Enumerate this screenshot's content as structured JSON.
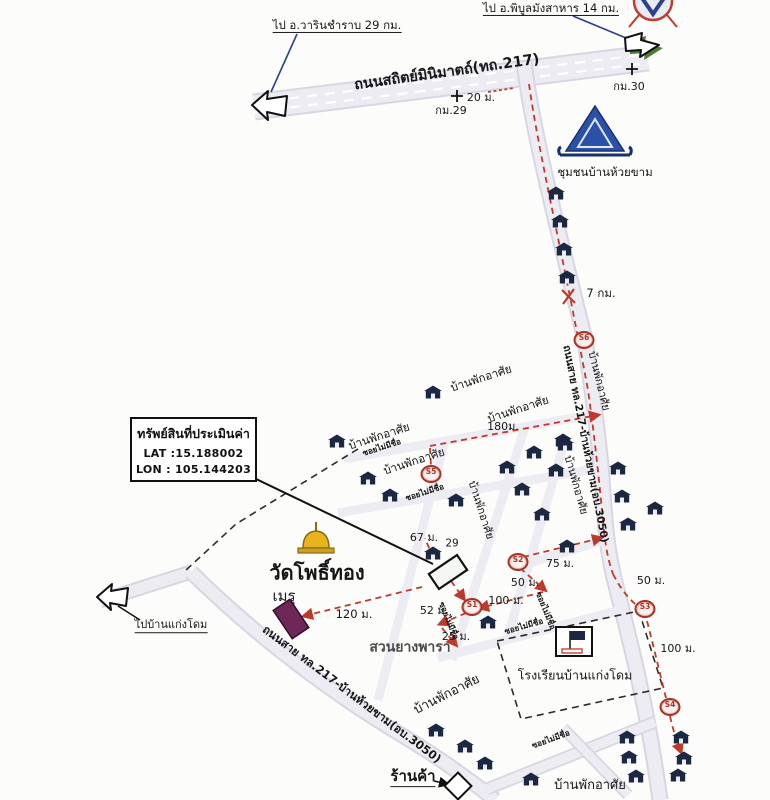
{
  "colors": {
    "road_fill": "#ececf2",
    "road_edge": "#d7d7e2",
    "route_red": "#bf3a2c",
    "house_navy": "#1c2742",
    "temple_blue": "#2b51a7",
    "pagoda_gold": "#e7b31f",
    "meru_purple": "#6f2757",
    "leader_blue": "#2c3f8f",
    "arrow_shadow_green": "#4d7c33"
  },
  "property_box": {
    "title": "ทรัพย์สินที่ประเมินค่า",
    "lat": "LAT :15.188002",
    "lon": "LON : 105.144203"
  },
  "stations": [
    {
      "label": "S1",
      "x": 472,
      "y": 607
    },
    {
      "label": "S2",
      "x": 518,
      "y": 562
    },
    {
      "label": "S3",
      "x": 645,
      "y": 609
    },
    {
      "label": "S4",
      "x": 670,
      "y": 707
    },
    {
      "label": "S5",
      "x": 431,
      "y": 474
    },
    {
      "label": "S6",
      "x": 584,
      "y": 340
    }
  ],
  "houses": [
    [
      556,
      193
    ],
    [
      560,
      221
    ],
    [
      564,
      249
    ],
    [
      567,
      277
    ],
    [
      563,
      440
    ],
    [
      556,
      470
    ],
    [
      618,
      468
    ],
    [
      622,
      496
    ],
    [
      628,
      524
    ],
    [
      655,
      508
    ],
    [
      433,
      392
    ],
    [
      337,
      441
    ],
    [
      368,
      478
    ],
    [
      390,
      495
    ],
    [
      565,
      444
    ],
    [
      534,
      452
    ],
    [
      507,
      467
    ],
    [
      522,
      489
    ],
    [
      542,
      514
    ],
    [
      567,
      546
    ],
    [
      456,
      500
    ],
    [
      488,
      622
    ],
    [
      433,
      553
    ],
    [
      436,
      730
    ],
    [
      465,
      746
    ],
    [
      485,
      763
    ],
    [
      627,
      737
    ],
    [
      629,
      757
    ],
    [
      636,
      776
    ],
    [
      681,
      737
    ],
    [
      684,
      758
    ],
    [
      678,
      775
    ],
    [
      531,
      779
    ]
  ],
  "labels": [
    {
      "name": "dest-warin",
      "text": "ไป อ.วารินชำราบ 29 กม.",
      "x": 337,
      "y": 26,
      "fs": 11.5,
      "rot": 0,
      "cls": "u"
    },
    {
      "name": "dest-phibun",
      "text": "ไป อ.พิบูลมังสาหาร 14 กม.",
      "x": 551,
      "y": 9,
      "fs": 11.5,
      "rot": 0,
      "cls": "u"
    },
    {
      "name": "highway-217-name",
      "text": "ถนนสถิตย์มินิมาตถ์(ทถ.217)",
      "x": 447,
      "y": 73,
      "fs": 14.5,
      "rot": -8,
      "cls": "b"
    },
    {
      "name": "dist-20m",
      "text": "20 ม.",
      "x": 481,
      "y": 98,
      "fs": 11,
      "rot": 0,
      "cls": ""
    },
    {
      "name": "km-29",
      "text": "กม.29",
      "x": 451,
      "y": 111,
      "fs": 11,
      "rot": 0,
      "cls": ""
    },
    {
      "name": "km-30",
      "text": "กม.30",
      "x": 629,
      "y": 87,
      "fs": 11,
      "rot": 0,
      "cls": ""
    },
    {
      "name": "community-huai-kham",
      "text": "ชุมชนบ้านห้วยขาม",
      "x": 605,
      "y": 172,
      "fs": 11.5,
      "rot": 0,
      "cls": ""
    },
    {
      "name": "dist-7km",
      "text": "7 กม.",
      "x": 601,
      "y": 293,
      "fs": 11.5,
      "rot": 0,
      "cls": ""
    },
    {
      "name": "road-3050-north",
      "text": "ถนนสาย ทล.217-บ้านห้วยขาม(อบ.3050)",
      "x": 585,
      "y": 444,
      "fs": 10.5,
      "rot": 79,
      "cls": "b"
    },
    {
      "name": "residences-r1",
      "text": "บ้านพักอาศัย",
      "x": 599,
      "y": 381,
      "fs": 11,
      "rot": 76,
      "cls": ""
    },
    {
      "name": "residences-r2",
      "text": "บ้านพักอาศัย",
      "x": 576,
      "y": 485,
      "fs": 11,
      "rot": 74,
      "cls": ""
    },
    {
      "name": "residences-g1",
      "text": "บ้านพักอาศัย",
      "x": 481,
      "y": 378,
      "fs": 11.5,
      "rot": -18,
      "cls": ""
    },
    {
      "name": "residences-g2",
      "text": "บ้านพักอาศัย",
      "x": 518,
      "y": 409,
      "fs": 11.5,
      "rot": -18,
      "cls": ""
    },
    {
      "name": "residences-g3",
      "text": "บ้านพักอาศัย",
      "x": 379,
      "y": 436,
      "fs": 11.5,
      "rot": -18,
      "cls": ""
    },
    {
      "name": "residences-g4",
      "text": "บ้านพักอาศัย",
      "x": 414,
      "y": 461,
      "fs": 11.5,
      "rot": -18,
      "cls": ""
    },
    {
      "name": "residences-g5",
      "text": "บ้านพักอาศัย",
      "x": 481,
      "y": 510,
      "fs": 11,
      "rot": 72,
      "cls": ""
    },
    {
      "name": "soi-no-name-1",
      "text": "ซอยไม่มีชื่อ",
      "x": 382,
      "y": 448,
      "fs": 8,
      "rot": -18,
      "cls": "b"
    },
    {
      "name": "soi-no-name-2",
      "text": "ซอยไม่มีชื่อ",
      "x": 425,
      "y": 493,
      "fs": 8,
      "rot": -18,
      "cls": "b"
    },
    {
      "name": "soi-no-name-3",
      "text": "ซอยไม่มีชื่อ",
      "x": 545,
      "y": 611,
      "fs": 8,
      "rot": 68,
      "cls": "b"
    },
    {
      "name": "soi-no-name-4",
      "text": "ซอยไม่มีชื่อ",
      "x": 448,
      "y": 621,
      "fs": 8,
      "rot": 68,
      "cls": "b"
    },
    {
      "name": "soi-no-name-5",
      "text": "ซอยไม่มีชื่อ",
      "x": 551,
      "y": 740,
      "fs": 8,
      "rot": -20,
      "cls": "b"
    },
    {
      "name": "soi-no-name-6",
      "text": "ซอยไม่มีชื่อ",
      "x": 524,
      "y": 627,
      "fs": 8,
      "rot": -16,
      "cls": "b"
    },
    {
      "name": "dist-180m",
      "text": "180ม.",
      "x": 503,
      "y": 427,
      "fs": 11,
      "rot": 0,
      "cls": ""
    },
    {
      "name": "dist-67m",
      "text": "67 ม.",
      "x": 424,
      "y": 538,
      "fs": 11,
      "rot": 0,
      "cls": ""
    },
    {
      "name": "house-number-29",
      "text": "29",
      "x": 452,
      "y": 544,
      "fs": 10.5,
      "rot": 0,
      "cls": ""
    },
    {
      "name": "dist-75m",
      "text": "75 ม.",
      "x": 560,
      "y": 564,
      "fs": 11,
      "rot": 0,
      "cls": ""
    },
    {
      "name": "dist-50m-a",
      "text": "50 ม.",
      "x": 525,
      "y": 583,
      "fs": 11,
      "rot": 0,
      "cls": ""
    },
    {
      "name": "dist-100m-a",
      "text": "100 ม.",
      "x": 506,
      "y": 601,
      "fs": 11,
      "rot": 0,
      "cls": ""
    },
    {
      "name": "dist-52m",
      "text": "52 ม.",
      "x": 434,
      "y": 611,
      "fs": 11,
      "rot": 0,
      "cls": ""
    },
    {
      "name": "dist-25m",
      "text": "25 ม.",
      "x": 456,
      "y": 637,
      "fs": 11,
      "rot": 0,
      "cls": ""
    },
    {
      "name": "dist-120m",
      "text": "120 ม.",
      "x": 354,
      "y": 614,
      "fs": 11.5,
      "rot": 0,
      "cls": ""
    },
    {
      "name": "wat-pho-thong",
      "text": "วัดโพธิ์ทอง",
      "x": 317,
      "y": 573,
      "fs": 20,
      "rot": 0,
      "cls": "b"
    },
    {
      "name": "meru-label",
      "text": "เมรุ",
      "x": 284,
      "y": 597,
      "fs": 15,
      "rot": 0,
      "cls": ""
    },
    {
      "name": "rubber-plantation",
      "text": "สวนยางพารา",
      "x": 410,
      "y": 648,
      "fs": 14,
      "rot": 0,
      "cls": "gray b"
    },
    {
      "name": "road-3050-south",
      "text": "ถนนสาย ทล.217-บ้านห้วยขาม(อบ.3050)",
      "x": 352,
      "y": 694,
      "fs": 11.5,
      "rot": 37,
      "cls": "b"
    },
    {
      "name": "to-ban-kaeng-dome",
      "text": "ไปบ้านแก่งโดม",
      "x": 171,
      "y": 626,
      "fs": 11,
      "rot": 0,
      "cls": "u"
    },
    {
      "name": "school-ban-kaeng-dome",
      "text": "โรงเรียนบ้านแก่งโดม",
      "x": 575,
      "y": 675,
      "fs": 12.5,
      "rot": 0,
      "cls": ""
    },
    {
      "name": "dist-50m-b",
      "text": "50 ม.",
      "x": 651,
      "y": 581,
      "fs": 11,
      "rot": 0,
      "cls": ""
    },
    {
      "name": "dist-100m-b",
      "text": "100 ม.",
      "x": 678,
      "y": 649,
      "fs": 11,
      "rot": 0,
      "cls": ""
    },
    {
      "name": "shop-label",
      "text": "ร้านค้า",
      "x": 413,
      "y": 778,
      "fs": 15,
      "rot": 0,
      "cls": "b u"
    },
    {
      "name": "residences-b1",
      "text": "บ้านพักอาศัย",
      "x": 447,
      "y": 695,
      "fs": 13,
      "rot": -27,
      "cls": ""
    },
    {
      "name": "residences-b2",
      "text": "บ้านพักอาศัย",
      "x": 590,
      "y": 786,
      "fs": 13,
      "rot": 0,
      "cls": ""
    }
  ]
}
